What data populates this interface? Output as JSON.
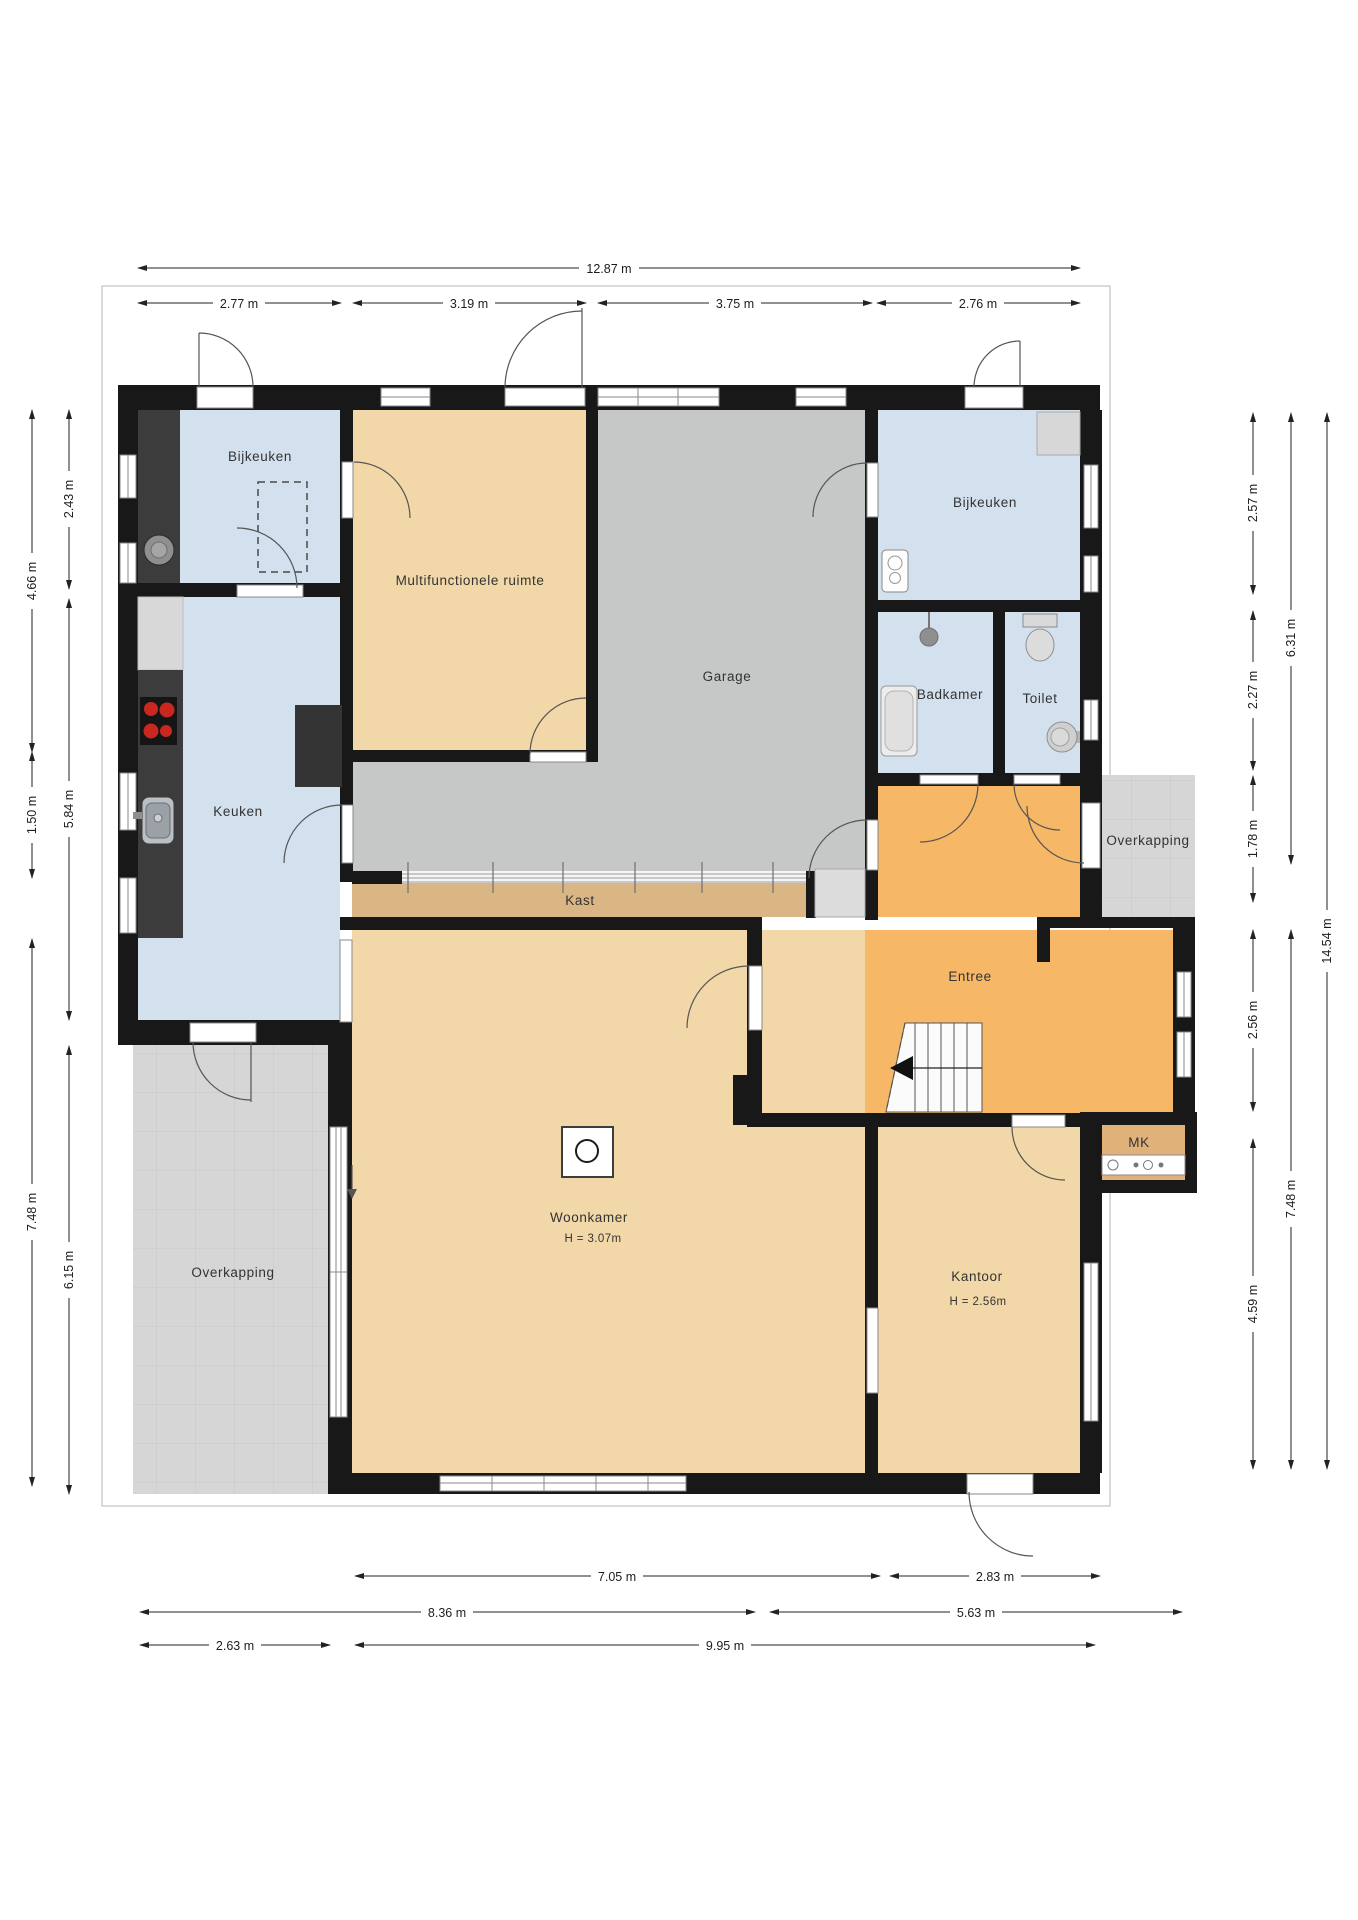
{
  "rooms": {
    "bijkeuken_tl": "Bijkeuken",
    "multifunctionele": "Multifunctionele ruimte",
    "garage": "Garage",
    "bijkeuken_tr": "Bijkeuken",
    "badkamer": "Badkamer",
    "toilet": "Toilet",
    "keuken": "Keuken",
    "kast": "Kast",
    "entree": "Entree",
    "woonkamer": "Woonkamer",
    "woonkamer_height": "H = 3.07m",
    "kantoor": "Kantoor",
    "kantoor_height": "H = 2.56m",
    "mk": "MK",
    "overkapping_left": "Overkapping",
    "overkapping_right": "Overkapping"
  },
  "dims": {
    "top_total": "12.87 m",
    "top": [
      "2.77 m",
      "3.19 m",
      "3.75 m",
      "2.76 m"
    ],
    "left_outer": [
      "4.66 m",
      "1.50 m",
      "7.48 m"
    ],
    "left_inner": [
      "2.43 m",
      "5.84 m",
      "6.15 m"
    ],
    "right_inner": [
      "2.57 m",
      "2.27 m",
      "1.78 m",
      "2.56 m",
      "4.59 m"
    ],
    "right_mid": [
      "6.31 m",
      "7.48 m"
    ],
    "right_total": "14.54 m",
    "bottom_row1": [
      "7.05 m",
      "2.83 m"
    ],
    "bottom_row2": [
      "8.36 m",
      "5.63 m"
    ],
    "bottom_row3": [
      "2.63 m",
      "9.95 m"
    ]
  },
  "colors": {
    "wall": "#181818",
    "floor_blue": "#d3e1ef",
    "floor_tan": "#f2d8a9",
    "floor_orange": "#f6b766",
    "floor_garage": "#c6c7c7",
    "floor_kast": "#d9b684",
    "floor_mk": "#e0b27a",
    "tile": "#d6d6d6",
    "tile_line": "#c8c8c8",
    "counter_dark": "#3c3c3c",
    "counter_light": "#d8d8d8",
    "burner_red": "#c8281e",
    "dim_text": "#1d1d1d",
    "label_text": "#333333"
  }
}
